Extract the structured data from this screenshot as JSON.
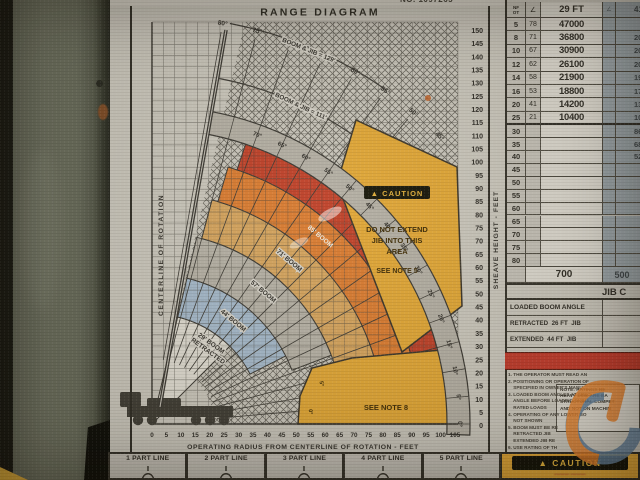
{
  "photo": {
    "top_edge_partial": "NO. 1097265"
  },
  "diagram": {
    "title": "RANGE DIAGRAM",
    "centerline_label": "CENTERLINE OF ROTATION",
    "sheave_axis_label": "SHEAVE HEIGHT - FEET",
    "radius_axis_label": "OPERATING RADIUS FROM CENTERLINE OF ROTATION - FEET",
    "sheave_ticks": [
      150,
      145,
      140,
      135,
      130,
      125,
      120,
      115,
      110,
      105,
      100,
      95,
      90,
      85,
      80,
      75,
      70,
      65,
      60,
      55,
      50,
      45,
      40,
      35,
      30,
      25,
      20,
      15,
      10,
      5,
      0
    ],
    "radius_ticks": [
      0,
      5,
      10,
      15,
      20,
      25,
      30,
      35,
      40,
      45,
      50,
      55,
      60,
      65,
      70,
      75,
      80,
      85,
      90,
      95,
      100,
      105
    ],
    "band_angle_labels": [
      "0°",
      "5°",
      "10°",
      "15°",
      "20°",
      "25°",
      "30°",
      "35°",
      "40°",
      "45°",
      "50°",
      "55°",
      "60°",
      "65°",
      "70°"
    ],
    "margin_angle_labels": [
      "45°",
      "50°",
      "55°",
      "60°",
      "65°",
      "70°",
      "75°",
      "80°"
    ],
    "boom_jib_labels": [
      "BOOM & JIB = 129'",
      "BOOM & JIB = 111'"
    ],
    "sector_labels": {
      "s29a": "29' BOOM",
      "s29b": "RETRACTED",
      "s44": "44' BOOM",
      "s57": "57' BOOM",
      "s71": "71' BOOM",
      "s85": "85' BOOM"
    },
    "caution_area": {
      "icon": "▲",
      "badge": "CAUTION",
      "line1": "DO NOT EXTEND",
      "line2": "JIB INTO THIS",
      "line3": "AREA",
      "line4": "SEE NOTE 5"
    },
    "see_note_8": "SEE NOTE 8",
    "low_angle_labels": [
      "5°",
      "0°"
    ]
  },
  "load_chart": {
    "corner_header_top": "NF",
    "corner_header_bottom": "OT",
    "angle_symbol": "∠",
    "boom_header": "29 FT",
    "boom_header_2": "41",
    "rows": [
      {
        "r": "5",
        "a": "78",
        "c": "47000",
        "c2": ""
      },
      {
        "r": "8",
        "a": "71",
        "c": "36800",
        "c2": "20"
      },
      {
        "r": "10",
        "a": "67",
        "c": "30900",
        "c2": "20"
      },
      {
        "r": "12",
        "a": "62",
        "c": "26100",
        "c2": "20"
      },
      {
        "r": "14",
        "a": "58",
        "c": "21900",
        "c2": "19"
      },
      {
        "r": "16",
        "a": "53",
        "c": "18800",
        "c2": "17"
      },
      {
        "r": "20",
        "a": "41",
        "c": "14200",
        "c2": "13"
      },
      {
        "r": "25",
        "a": "21",
        "c": "10400",
        "c2": "10"
      }
    ],
    "empty_rows": [
      {
        "r": "30",
        "c2": "86"
      },
      {
        "r": "35",
        "c2": "68"
      },
      {
        "r": "40",
        "c2": "52"
      },
      {
        "r": "45",
        "c2": ""
      },
      {
        "r": "50",
        "c2": ""
      },
      {
        "r": "55",
        "c2": ""
      },
      {
        "r": "60",
        "c2": ""
      },
      {
        "r": "65",
        "c2": ""
      },
      {
        "r": "70",
        "c2": ""
      },
      {
        "r": "75",
        "c2": ""
      },
      {
        "r": "80",
        "c2": ""
      }
    ],
    "min_row": {
      "left": "700",
      "right": "500"
    },
    "note_box_lines": [
      "NOTE: RATINGS BE",
      "HEAVY LINE ARE BA",
      "STRUCTURAL COMPET",
      "AND NOT ON MACHIN"
    ]
  },
  "jib_section": {
    "header_partial": "JIB C",
    "row1": "LOADED BOOM ANGLE",
    "row2": "RETRACTED  26 FT  JIB",
    "row3": "EXTENDED  44 FT  JIB"
  },
  "notes_panel": {
    "lines": [
      "1. THE OPERATOR MUST READ AN",
      "2. POSITIONING OR OPERATION OF",
      "    SPECIFIED IN OWNER'S MANU",
      "3. LOADED BOOM ANGLES AT SPEC",
      "    ANGLE BEFORE LOADING SHOUL",
      "    RATED LOADS",
      "4. OPERATING OF ANY LOWER BO",
      "    NOT SHOWN",
      "5. BOOM MUST BE RE",
      "    RETRACTED JIB",
      "    EXTENDED JIB RE",
      "6. USE RATING OF TH",
      "7. LIFTING OFF THE",
      "8. DO NOT LOWER BO",
      "    WITHOUT RETRACT"
    ]
  },
  "part_lines": [
    "1 PART LINE",
    "2 PART LINE",
    "3 PART LINE",
    "4 PART LINE",
    "5 PART LINE"
  ],
  "caution_box": {
    "icon": "▲",
    "badge": "CAUTION",
    "illegible_text": "———  ———"
  },
  "colors": {
    "yellow": "#e0a636",
    "red_band": "#bf4029",
    "orange_band": "#d97b31",
    "tan_band": "#d4a35e",
    "gray_band": "#b4b0a6",
    "blue_band": "#a3b8cb",
    "white_band": "#dedbd2",
    "angle_band": "#b2aea4",
    "red_bar": "#bf3a2c"
  }
}
